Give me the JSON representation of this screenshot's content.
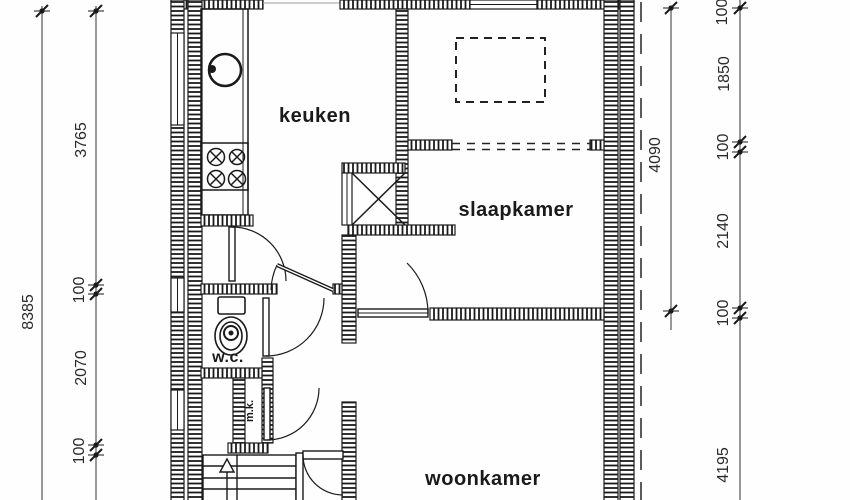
{
  "drawing": {
    "kind": "floor-plan",
    "language": "nl"
  },
  "rooms": {
    "keuken": "keuken",
    "slaapkamer": "slaapkamer",
    "woonkamer": "woonkamer",
    "wc": "w.c.",
    "mk": "m.k."
  },
  "dimensions": {
    "left_total": "8385",
    "left_segments": [
      "3765",
      "100",
      "2070",
      "100"
    ],
    "right_inner_total": "4090",
    "right_segments": [
      "100",
      "1850",
      "100",
      "2140",
      "100",
      "4195"
    ]
  },
  "colors": {
    "ink": "#1a1a1a",
    "dim_line": "#444444",
    "background": "#fefefe"
  }
}
